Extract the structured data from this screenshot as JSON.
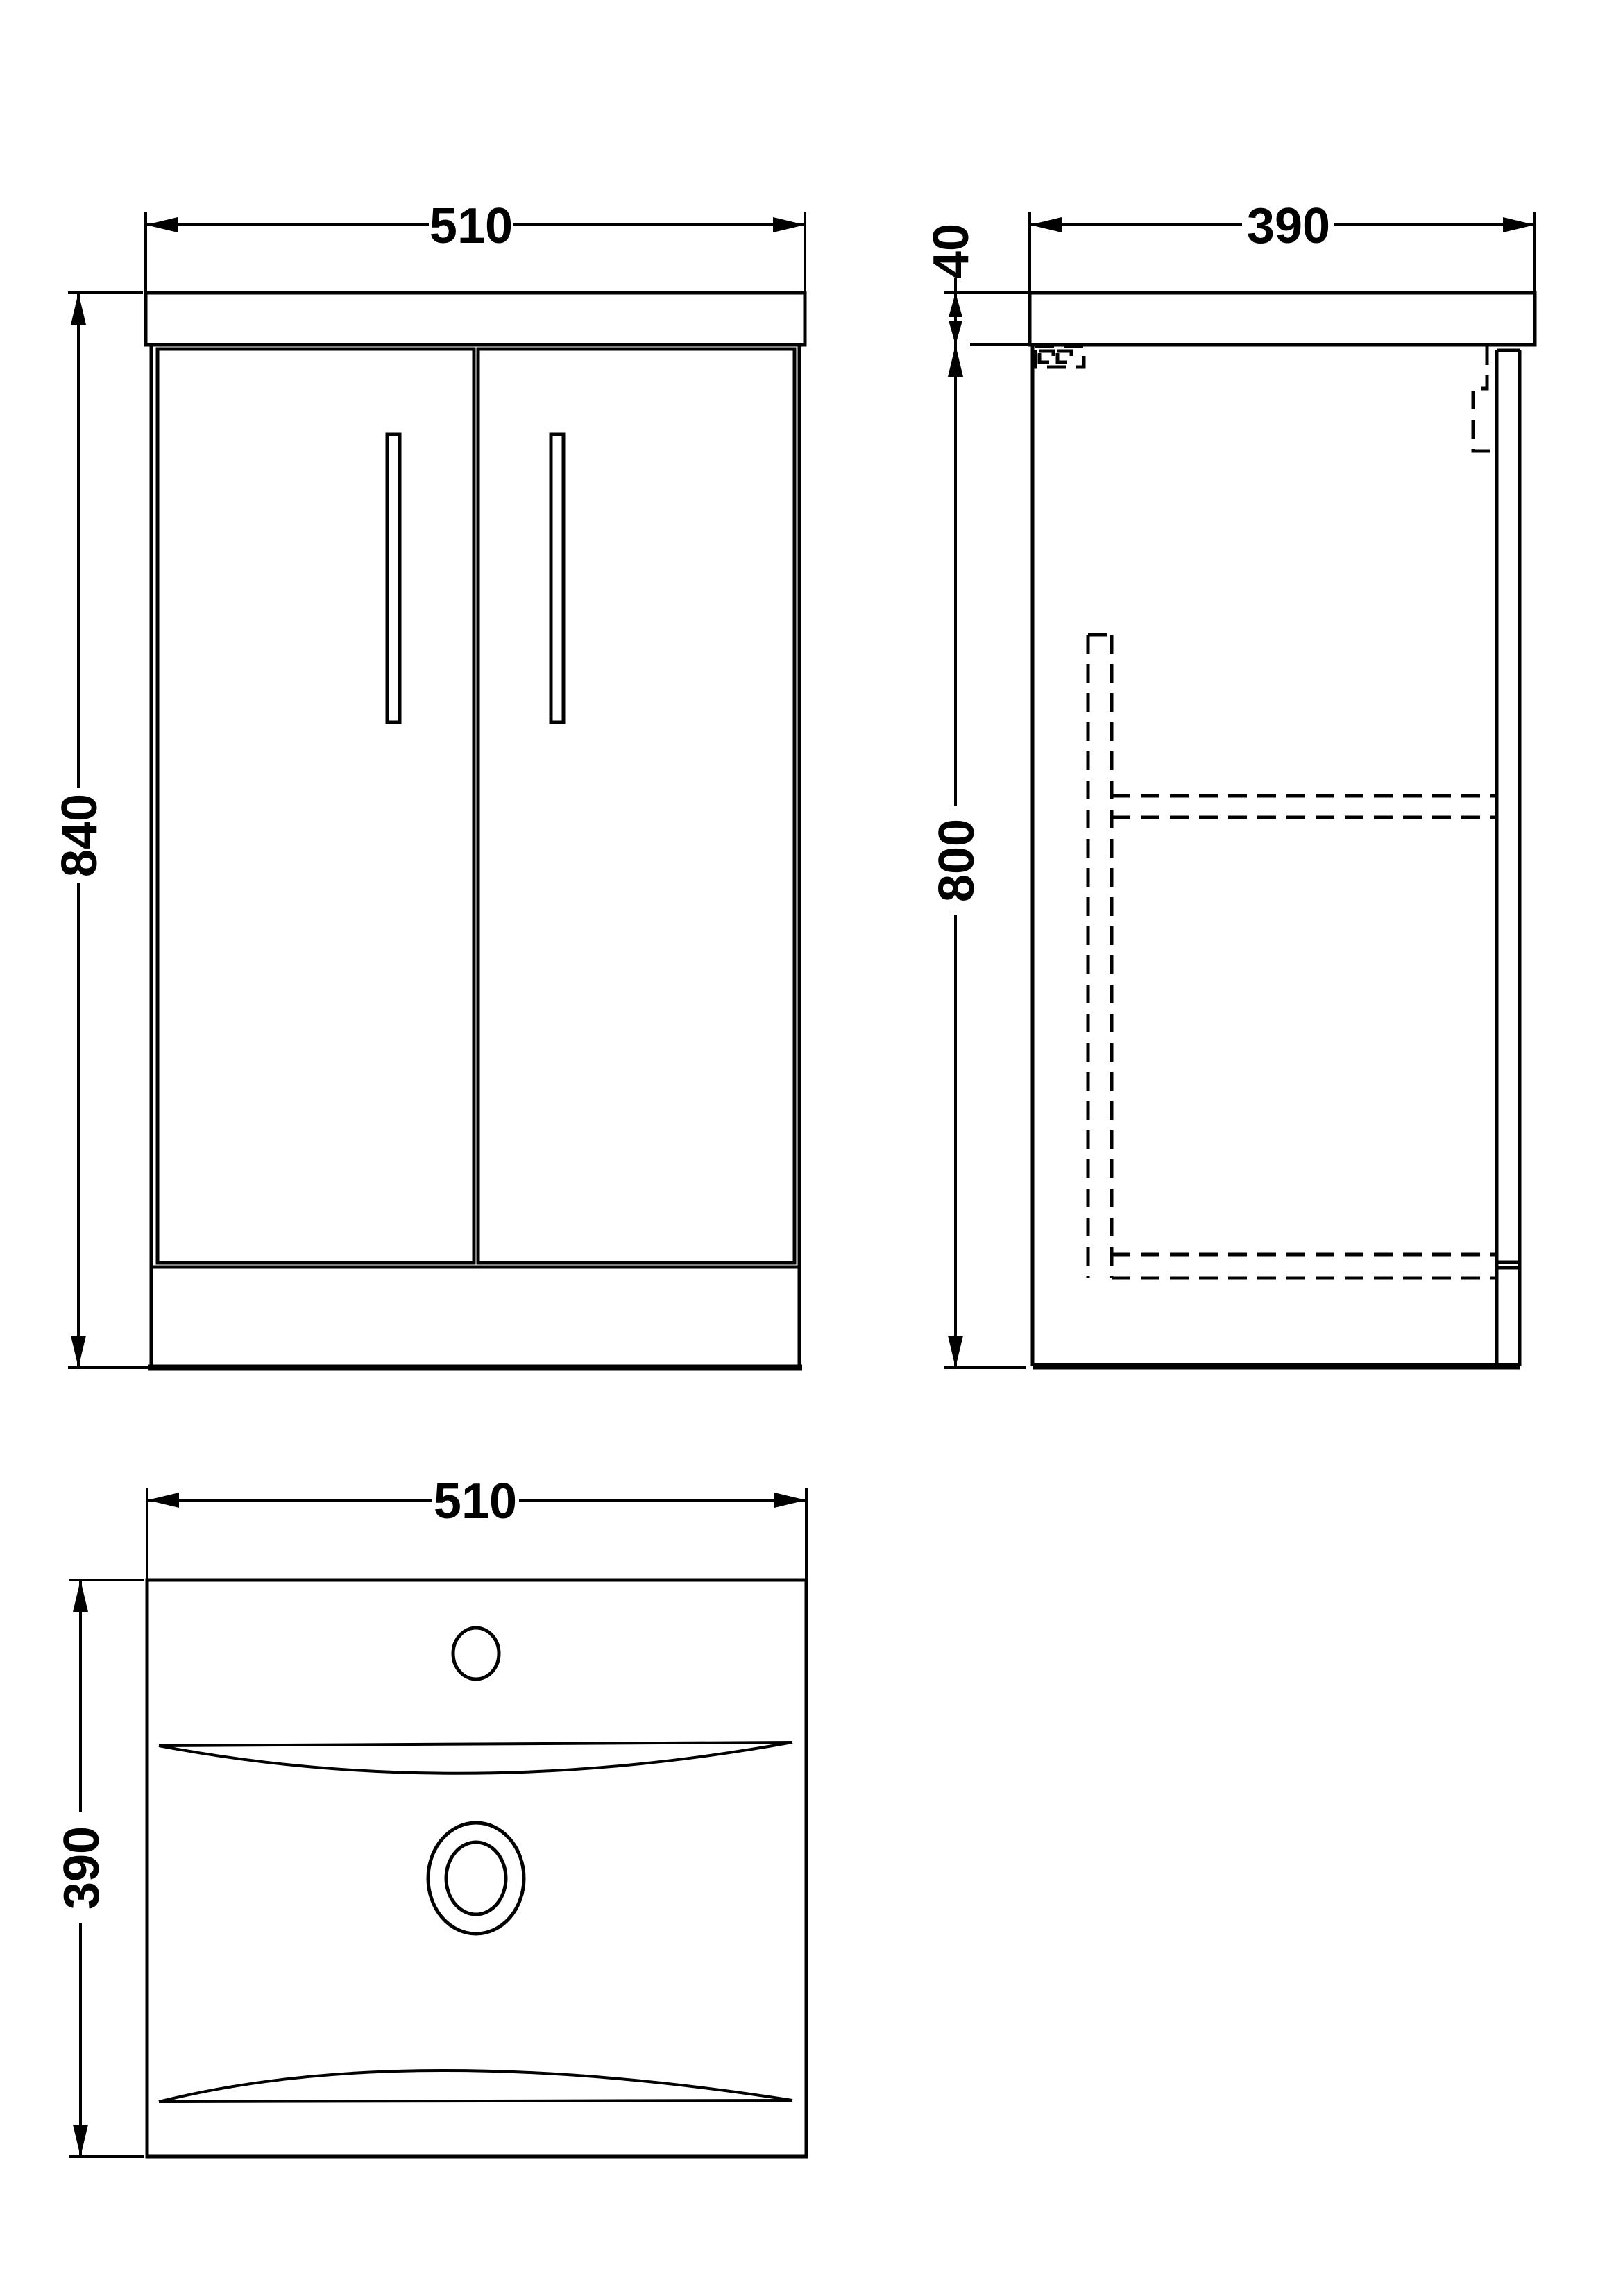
{
  "drawing": {
    "type": "technical-orthographic-drawing",
    "subject": "vanity-unit-with-basin",
    "background_color": "#ffffff",
    "line_color": "#000000",
    "views": {
      "front": {
        "title": "front elevation",
        "width": "510",
        "height": "840"
      },
      "side": {
        "title": "side elevation",
        "width": "390",
        "top_thickness": "40",
        "body_height": "800"
      },
      "plan": {
        "title": "basin plan",
        "width": "510",
        "depth": "390"
      }
    }
  }
}
